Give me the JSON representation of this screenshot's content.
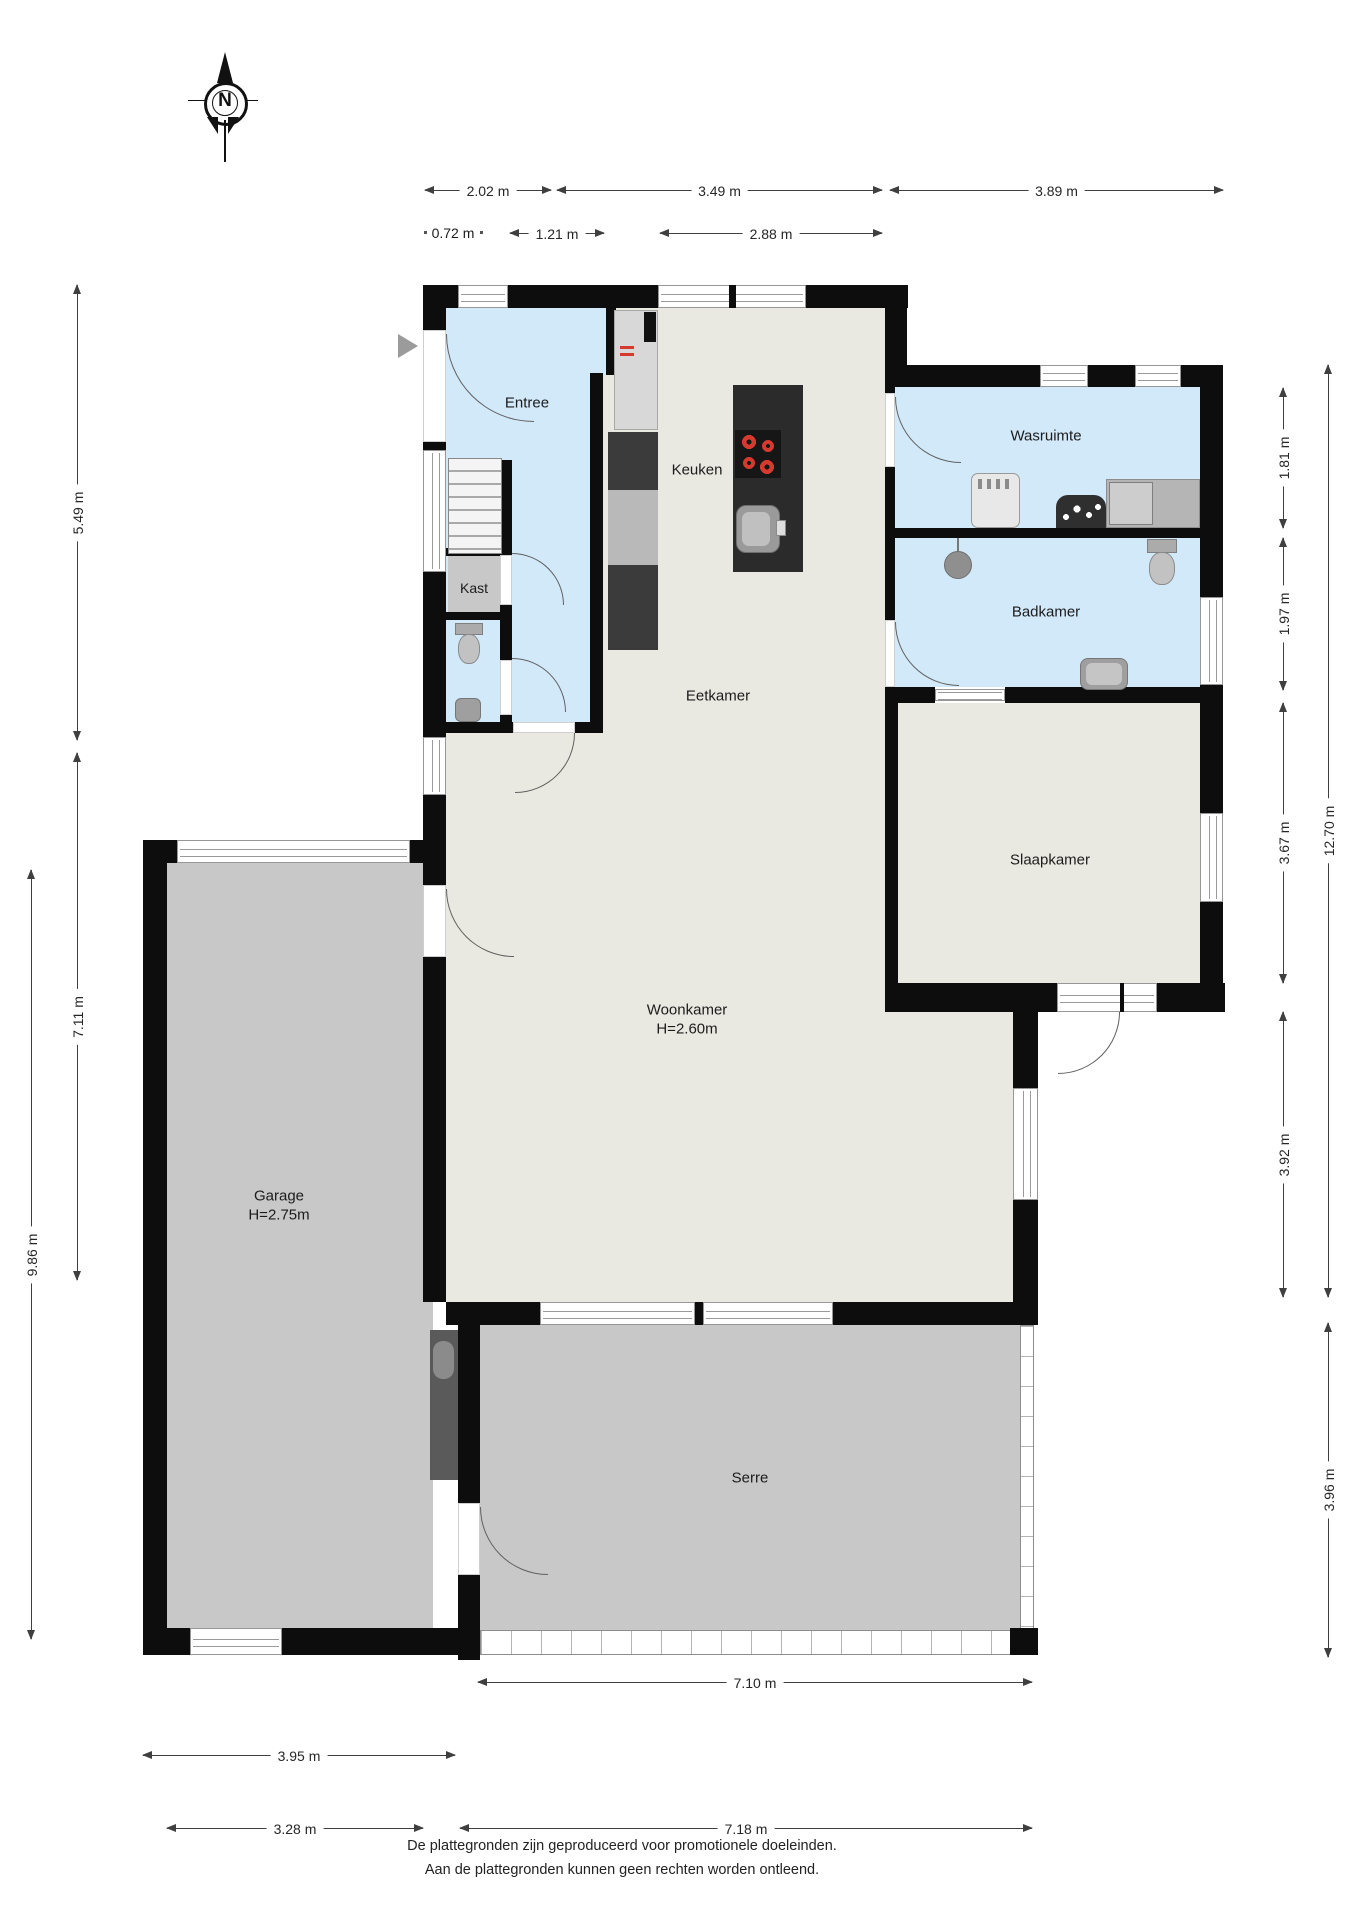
{
  "title": "Floor plan (begane grond)",
  "compass": {
    "label": "N"
  },
  "rooms": {
    "entree": "Entree",
    "kast": "Kast",
    "keuken": "Keuken",
    "eetkamer": "Eetkamer",
    "woonkamer": "Woonkamer",
    "woonkamer_height": "H=2.60m",
    "garage": "Garage",
    "garage_height": "H=2.75m",
    "serre": "Serre",
    "wasruimte": "Wasruimte",
    "badkamer": "Badkamer",
    "slaapkamer": "Slaapkamer"
  },
  "dimensions": {
    "top_row1": [
      "2.02 m",
      "3.49 m",
      "3.89 m"
    ],
    "top_row2": [
      "0.72 m",
      "1.21 m",
      "2.88 m"
    ],
    "left": [
      "5.49 m",
      "7.11 m",
      "9.86 m"
    ],
    "right_inner": [
      "1.81 m",
      "1.97 m",
      "3.67 m",
      "3.92 m"
    ],
    "right_outer": [
      "12.70 m",
      "3.96 m"
    ],
    "bottom": [
      "7.10 m",
      "3.95 m",
      "3.28 m",
      "7.18 m"
    ]
  },
  "footer": {
    "line1": "De plattegronden zijn geproduceerd voor promotionele doeleinden.",
    "line2": "Aan de plattegronden kunnen geen rechten worden ontleend."
  },
  "colors": {
    "wall": "#0d0d0d",
    "wet_room_floor": "#d2e9f9",
    "living_floor": "#eae9e1",
    "garage_serre_floor": "#c8c8c8",
    "kitchen_island": "#2b2b2b",
    "hob_burner": "#d63a2f",
    "dimension_line": "#3f3f3f"
  }
}
